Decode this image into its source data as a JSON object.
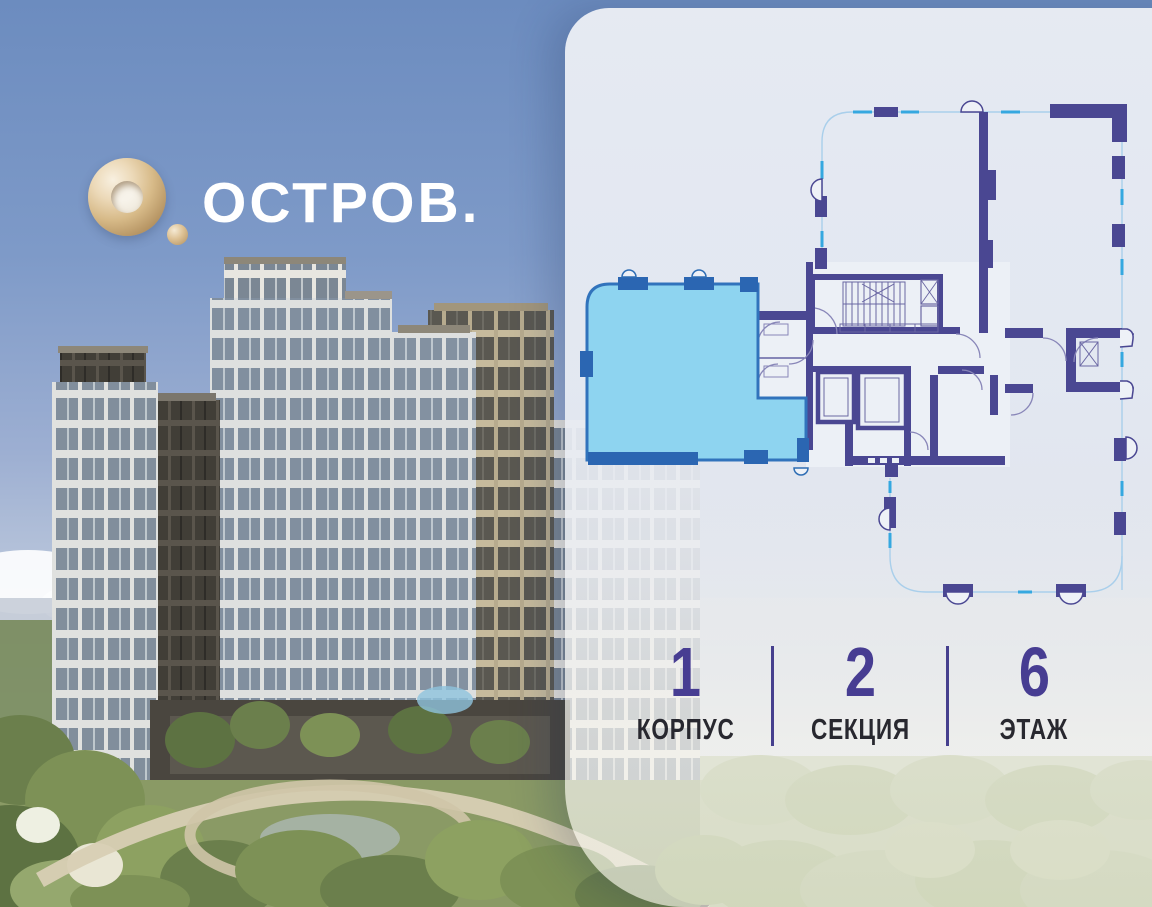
{
  "brand": {
    "name": "ОСТРОВ.",
    "logo_icon": "gold-torus-with-dot"
  },
  "floor_plan": {
    "description": "floor plan with one selected apartment highlighted",
    "selected_fill": "#8ED4F0",
    "selected_border": "#3173BC",
    "wall_color": "#4A4792",
    "outline_dash_color": "#35A8E0"
  },
  "location_info": {
    "items": [
      {
        "value": "1",
        "label": "КОРПУС"
      },
      {
        "value": "2",
        "label": "СЕКЦИЯ"
      },
      {
        "value": "6",
        "label": "ЭТАЖ"
      }
    ]
  },
  "colors": {
    "number_accent": "#473D92",
    "divider": "#46408E",
    "panel_background": "#E7EBF3",
    "sky": "#6D8DBF"
  }
}
